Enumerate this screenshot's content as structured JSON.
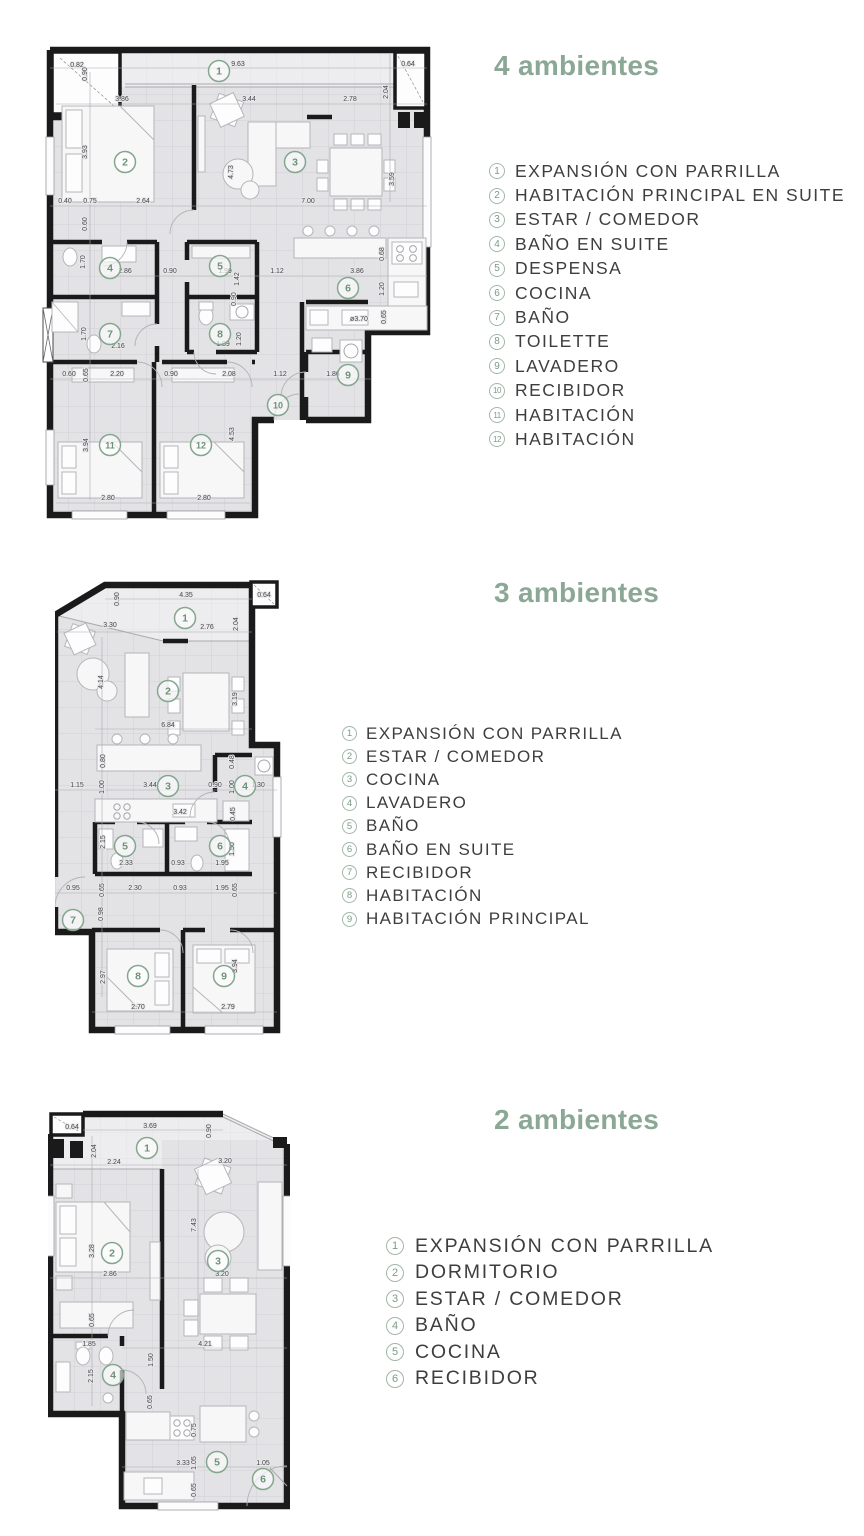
{
  "colors": {
    "accent_green": "#8ba795",
    "legend_badge_green": "#7c9a86",
    "marker_green": "#6d9376",
    "text_dark": "#3e3e40",
    "wall_black": "#1a1a1a",
    "floor_gray": "#e3e3e6"
  },
  "sections": [
    {
      "title": "4 ambientes",
      "legend": [
        {
          "num": "1",
          "label": "EXPANSIÓN CON PARRILLA"
        },
        {
          "num": "2",
          "label": "HABITACIÓN PRINCIPAL EN SUITE"
        },
        {
          "num": "3",
          "label": "ESTAR / COMEDOR"
        },
        {
          "num": "4",
          "label": "BAÑO EN SUITE"
        },
        {
          "num": "5",
          "label": "DESPENSA"
        },
        {
          "num": "6",
          "label": "COCINA"
        },
        {
          "num": "7",
          "label": "BAÑO"
        },
        {
          "num": "8",
          "label": "TOILETTE"
        },
        {
          "num": "9",
          "label": "LAVADERO"
        },
        {
          "num": "10",
          "label": "RECIBIDOR"
        },
        {
          "num": "11",
          "label": "HABITACIÓN"
        },
        {
          "num": "12",
          "label": "HABITACIÓN"
        }
      ],
      "plan": {
        "markers": [
          {
            "num": "1",
            "x": 177,
            "y": 29
          },
          {
            "num": "2",
            "x": 83,
            "y": 120
          },
          {
            "num": "3",
            "x": 253,
            "y": 120
          },
          {
            "num": "4",
            "x": 68,
            "y": 226
          },
          {
            "num": "5",
            "x": 178,
            "y": 224
          },
          {
            "num": "6",
            "x": 306,
            "y": 246
          },
          {
            "num": "7",
            "x": 68,
            "y": 292
          },
          {
            "num": "8",
            "x": 178,
            "y": 292
          },
          {
            "num": "9",
            "x": 306,
            "y": 333
          },
          {
            "num": "10",
            "x": 236,
            "y": 363
          },
          {
            "num": "11",
            "x": 68,
            "y": 403
          },
          {
            "num": "12",
            "x": 159,
            "y": 403
          }
        ],
        "dims": [
          {
            "t": "0.82",
            "x": 35,
            "y": 25
          },
          {
            "t": "0.90",
            "x": 45,
            "y": 32,
            "r": 1
          },
          {
            "t": "9.63",
            "x": 196,
            "y": 24
          },
          {
            "t": "0.64",
            "x": 366,
            "y": 24
          },
          {
            "t": "3.86",
            "x": 80,
            "y": 59
          },
          {
            "t": "3.44",
            "x": 207,
            "y": 59
          },
          {
            "t": "2.78",
            "x": 308,
            "y": 59
          },
          {
            "t": "2.04",
            "x": 346,
            "y": 50,
            "r": 1
          },
          {
            "t": "3.93",
            "x": 45,
            "y": 110,
            "r": 1
          },
          {
            "t": "4.73",
            "x": 191,
            "y": 130,
            "r": 1
          },
          {
            "t": "3.59",
            "x": 352,
            "y": 137,
            "r": 1
          },
          {
            "t": "0.40",
            "x": 23,
            "y": 161
          },
          {
            "t": "0.75",
            "x": 48,
            "y": 161
          },
          {
            "t": "2.64",
            "x": 101,
            "y": 161
          },
          {
            "t": "7.00",
            "x": 266,
            "y": 161
          },
          {
            "t": "0.60",
            "x": 45,
            "y": 182,
            "r": 1
          },
          {
            "t": "1.70",
            "x": 43,
            "y": 220,
            "r": 1
          },
          {
            "t": "2.86",
            "x": 83,
            "y": 231
          },
          {
            "t": "0.90",
            "x": 128,
            "y": 231
          },
          {
            "t": "1.99",
            "x": 183,
            "y": 231
          },
          {
            "t": "1.42",
            "x": 197,
            "y": 237,
            "r": 1
          },
          {
            "t": "1.12",
            "x": 235,
            "y": 231
          },
          {
            "t": "3.86",
            "x": 315,
            "y": 231
          },
          {
            "t": "0.68",
            "x": 342,
            "y": 212,
            "r": 1
          },
          {
            "t": "1.20",
            "x": 342,
            "y": 247,
            "r": 1
          },
          {
            "t": "0.90",
            "x": 194,
            "y": 257,
            "r": 1
          },
          {
            "t": "0.65",
            "x": 344,
            "y": 275,
            "r": 1
          },
          {
            "t": "ø3.70",
            "x": 317,
            "y": 279
          },
          {
            "t": "1.70",
            "x": 44,
            "y": 292,
            "r": 1
          },
          {
            "t": "2.16",
            "x": 76,
            "y": 306
          },
          {
            "t": "1.89",
            "x": 181,
            "y": 304
          },
          {
            "t": "1.20",
            "x": 199,
            "y": 297,
            "r": 1
          },
          {
            "t": "0.60",
            "x": 27,
            "y": 334
          },
          {
            "t": "0.65",
            "x": 46,
            "y": 333,
            "r": 1
          },
          {
            "t": "2.20",
            "x": 75,
            "y": 334
          },
          {
            "t": "0.90",
            "x": 129,
            "y": 334
          },
          {
            "t": "2.08",
            "x": 187,
            "y": 334
          },
          {
            "t": "1.12",
            "x": 238,
            "y": 334
          },
          {
            "t": "1.86",
            "x": 291,
            "y": 334
          },
          {
            "t": "4.53",
            "x": 192,
            "y": 392,
            "r": 1
          },
          {
            "t": "3.94",
            "x": 46,
            "y": 403,
            "r": 1
          },
          {
            "t": "2.80",
            "x": 66,
            "y": 458
          },
          {
            "t": "2.80",
            "x": 162,
            "y": 458
          }
        ]
      }
    },
    {
      "title": "3 ambientes",
      "legend": [
        {
          "num": "1",
          "label": "EXPANSIÓN CON PARRILLA"
        },
        {
          "num": "2",
          "label": "ESTAR / COMEDOR"
        },
        {
          "num": "3",
          "label": "COCINA"
        },
        {
          "num": "4",
          "label": "LAVADERO"
        },
        {
          "num": "5",
          "label": "BAÑO"
        },
        {
          "num": "6",
          "label": "BAÑO EN SUITE"
        },
        {
          "num": "7",
          "label": "RECIBIDOR"
        },
        {
          "num": "8",
          "label": "HABITACIÓN"
        },
        {
          "num": "9",
          "label": "HABITACIÓN PRINCIPAL"
        }
      ],
      "plan": {
        "markers": [
          {
            "num": "1",
            "x": 130,
            "y": 41
          },
          {
            "num": "2",
            "x": 113,
            "y": 114
          },
          {
            "num": "3",
            "x": 113,
            "y": 209
          },
          {
            "num": "4",
            "x": 190,
            "y": 209
          },
          {
            "num": "5",
            "x": 70,
            "y": 269
          },
          {
            "num": "6",
            "x": 165,
            "y": 269
          },
          {
            "num": "7",
            "x": 18,
            "y": 343
          },
          {
            "num": "8",
            "x": 83,
            "y": 399
          },
          {
            "num": "9",
            "x": 169,
            "y": 399
          }
        ],
        "dims": [
          {
            "t": "0.90",
            "x": 64,
            "y": 22,
            "r": 1
          },
          {
            "t": "4.35",
            "x": 131,
            "y": 20
          },
          {
            "t": "0.64",
            "x": 209,
            "y": 20
          },
          {
            "t": "3.30",
            "x": 55,
            "y": 50
          },
          {
            "t": "2.76",
            "x": 152,
            "y": 52
          },
          {
            "t": "2.04",
            "x": 183,
            "y": 47,
            "r": 1
          },
          {
            "t": "4.14",
            "x": 48,
            "y": 105,
            "r": 1
          },
          {
            "t": "3.19",
            "x": 182,
            "y": 122,
            "r": 1
          },
          {
            "t": "6.84",
            "x": 113,
            "y": 150
          },
          {
            "t": "0.80",
            "x": 50,
            "y": 184,
            "r": 1
          },
          {
            "t": "1.15",
            "x": 22,
            "y": 210
          },
          {
            "t": "1.00",
            "x": 49,
            "y": 210,
            "r": 1
          },
          {
            "t": "3.44",
            "x": 95,
            "y": 210
          },
          {
            "t": "0.90",
            "x": 160,
            "y": 210
          },
          {
            "t": "1.00",
            "x": 179,
            "y": 210,
            "r": 1
          },
          {
            "t": "1.30",
            "x": 203,
            "y": 210
          },
          {
            "t": "0.48",
            "x": 179,
            "y": 185,
            "r": 1
          },
          {
            "t": "3.42",
            "x": 125,
            "y": 237
          },
          {
            "t": "0.45",
            "x": 180,
            "y": 237,
            "r": 1
          },
          {
            "t": "2.15",
            "x": 50,
            "y": 265,
            "r": 1
          },
          {
            "t": "2.33",
            "x": 71,
            "y": 288
          },
          {
            "t": "0.93",
            "x": 123,
            "y": 288
          },
          {
            "t": "1.95",
            "x": 167,
            "y": 288
          },
          {
            "t": "1.50",
            "x": 179,
            "y": 272,
            "r": 1
          },
          {
            "t": "0.95",
            "x": 18,
            "y": 313
          },
          {
            "t": "0.65",
            "x": 49,
            "y": 313,
            "r": 1
          },
          {
            "t": "2.30",
            "x": 80,
            "y": 313
          },
          {
            "t": "0.93",
            "x": 125,
            "y": 313
          },
          {
            "t": "1.95",
            "x": 167,
            "y": 313
          },
          {
            "t": "0.65",
            "x": 182,
            "y": 313,
            "r": 1
          },
          {
            "t": "0.98",
            "x": 48,
            "y": 337,
            "r": 1
          },
          {
            "t": "2.97",
            "x": 50,
            "y": 400,
            "r": 1
          },
          {
            "t": "3.94",
            "x": 182,
            "y": 389,
            "r": 1
          },
          {
            "t": "2.70",
            "x": 83,
            "y": 432
          },
          {
            "t": "2.79",
            "x": 173,
            "y": 432
          }
        ]
      }
    },
    {
      "title": "2 ambientes",
      "legend": [
        {
          "num": "1",
          "label": "EXPANSIÓN CON PARRILLA"
        },
        {
          "num": "2",
          "label": "DORMITORIO"
        },
        {
          "num": "3",
          "label": "ESTAR / COMEDOR"
        },
        {
          "num": "4",
          "label": "BAÑO"
        },
        {
          "num": "5",
          "label": "COCINA"
        },
        {
          "num": "6",
          "label": "RECIBIDOR"
        }
      ],
      "plan": {
        "markers": [
          {
            "num": "1",
            "x": 99,
            "y": 42
          },
          {
            "num": "2",
            "x": 64,
            "y": 147
          },
          {
            "num": "3",
            "x": 170,
            "y": 155
          },
          {
            "num": "4",
            "x": 65,
            "y": 269
          },
          {
            "num": "5",
            "x": 169,
            "y": 356
          },
          {
            "num": "6",
            "x": 215,
            "y": 373
          }
        ],
        "dims": [
          {
            "t": "0.64",
            "x": 24,
            "y": 23
          },
          {
            "t": "3.69",
            "x": 102,
            "y": 22
          },
          {
            "t": "0.90",
            "x": 163,
            "y": 25,
            "r": 1
          },
          {
            "t": "2.04",
            "x": 48,
            "y": 45,
            "r": 1
          },
          {
            "t": "2.24",
            "x": 66,
            "y": 58
          },
          {
            "t": "3.20",
            "x": 177,
            "y": 57
          },
          {
            "t": "3.28",
            "x": 46,
            "y": 145,
            "r": 1
          },
          {
            "t": "2.86",
            "x": 62,
            "y": 170
          },
          {
            "t": "7.43",
            "x": 148,
            "y": 119,
            "r": 1
          },
          {
            "t": "3.20",
            "x": 174,
            "y": 170
          },
          {
            "t": "0.65",
            "x": 46,
            "y": 214,
            "r": 1
          },
          {
            "t": "1.85",
            "x": 41,
            "y": 240
          },
          {
            "t": "2.15",
            "x": 45,
            "y": 270,
            "r": 1
          },
          {
            "t": "1.50",
            "x": 105,
            "y": 254,
            "r": 1
          },
          {
            "t": "0.65",
            "x": 104,
            "y": 296,
            "r": 1
          },
          {
            "t": "4.21",
            "x": 157,
            "y": 240
          },
          {
            "t": "0.75",
            "x": 148,
            "y": 324,
            "r": 1
          },
          {
            "t": "3.33",
            "x": 135,
            "y": 359
          },
          {
            "t": "1.05",
            "x": 148,
            "y": 357,
            "r": 1
          },
          {
            "t": "1.05",
            "x": 215,
            "y": 359
          },
          {
            "t": "0.65",
            "x": 148,
            "y": 384,
            "r": 1
          }
        ]
      }
    }
  ]
}
